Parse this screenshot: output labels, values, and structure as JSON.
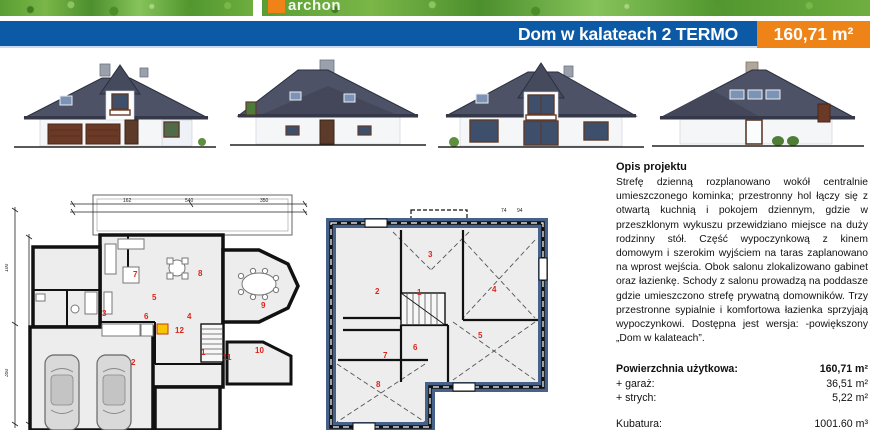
{
  "palette": {
    "header_blue": "#0c59a5",
    "badge_orange": "#ee8318",
    "plan_border_navy": "#47628a",
    "room_number_red": "#e02318",
    "roof_gray": "#4d5266"
  },
  "top_strip": {
    "logo_text": "archon"
  },
  "header": {
    "title": "Dom w kalateach 2 TERMO",
    "area_badge": "160,71 m²"
  },
  "elevations": [
    {
      "name": "front"
    },
    {
      "name": "left-side"
    },
    {
      "name": "rear"
    },
    {
      "name": "right-side"
    }
  ],
  "description": {
    "heading": "Opis projektu",
    "body": "Strefę dzienną rozplanowano wokół centralnie umieszczonego kominka; przestronny hol łączy się z otwartą kuchnią i pokojem dziennym, gdzie w przeszklonym wykuszu przewidziano miejsce na duży rodzinny stół. Część wypoczynkową z kinem domowym i szerokim wyjściem na taras zaplanowano na wprost wejścia. Obok salonu zlokalizowano gabinet oraz łazienkę. Schody z salonu prowadzą na poddasze gdzie umieszczono strefę prywatną domowników. Trzy przestronne sypialnie i komfortowa łazienka sprzyjają wypoczynkowi. Dostępna jest wersja: -powiększony „Dom w kalateach”."
  },
  "stats": {
    "rows": [
      {
        "label": "Powierzchnia użytkowa:",
        "value": "160,71 m²"
      },
      {
        "label": "+ garaż:",
        "value": "36,51 m²"
      },
      {
        "label": "+ strych:",
        "value": "5,22 m²"
      }
    ],
    "kubatura": {
      "label": "Kubatura:",
      "value": "1001.60 m³"
    }
  },
  "plans": {
    "ground": {
      "rooms": [
        "1",
        "2",
        "3",
        "4",
        "5",
        "6",
        "7",
        "8",
        "9",
        "10",
        "11",
        "12"
      ],
      "dims_top": [
        "162",
        "540",
        "350"
      ],
      "dims_left": [
        "100",
        "350"
      ]
    },
    "attic": {
      "rooms": [
        "1",
        "2",
        "3",
        "4",
        "5",
        "6",
        "7",
        "8"
      ],
      "dims": [
        "74",
        "94"
      ]
    }
  }
}
